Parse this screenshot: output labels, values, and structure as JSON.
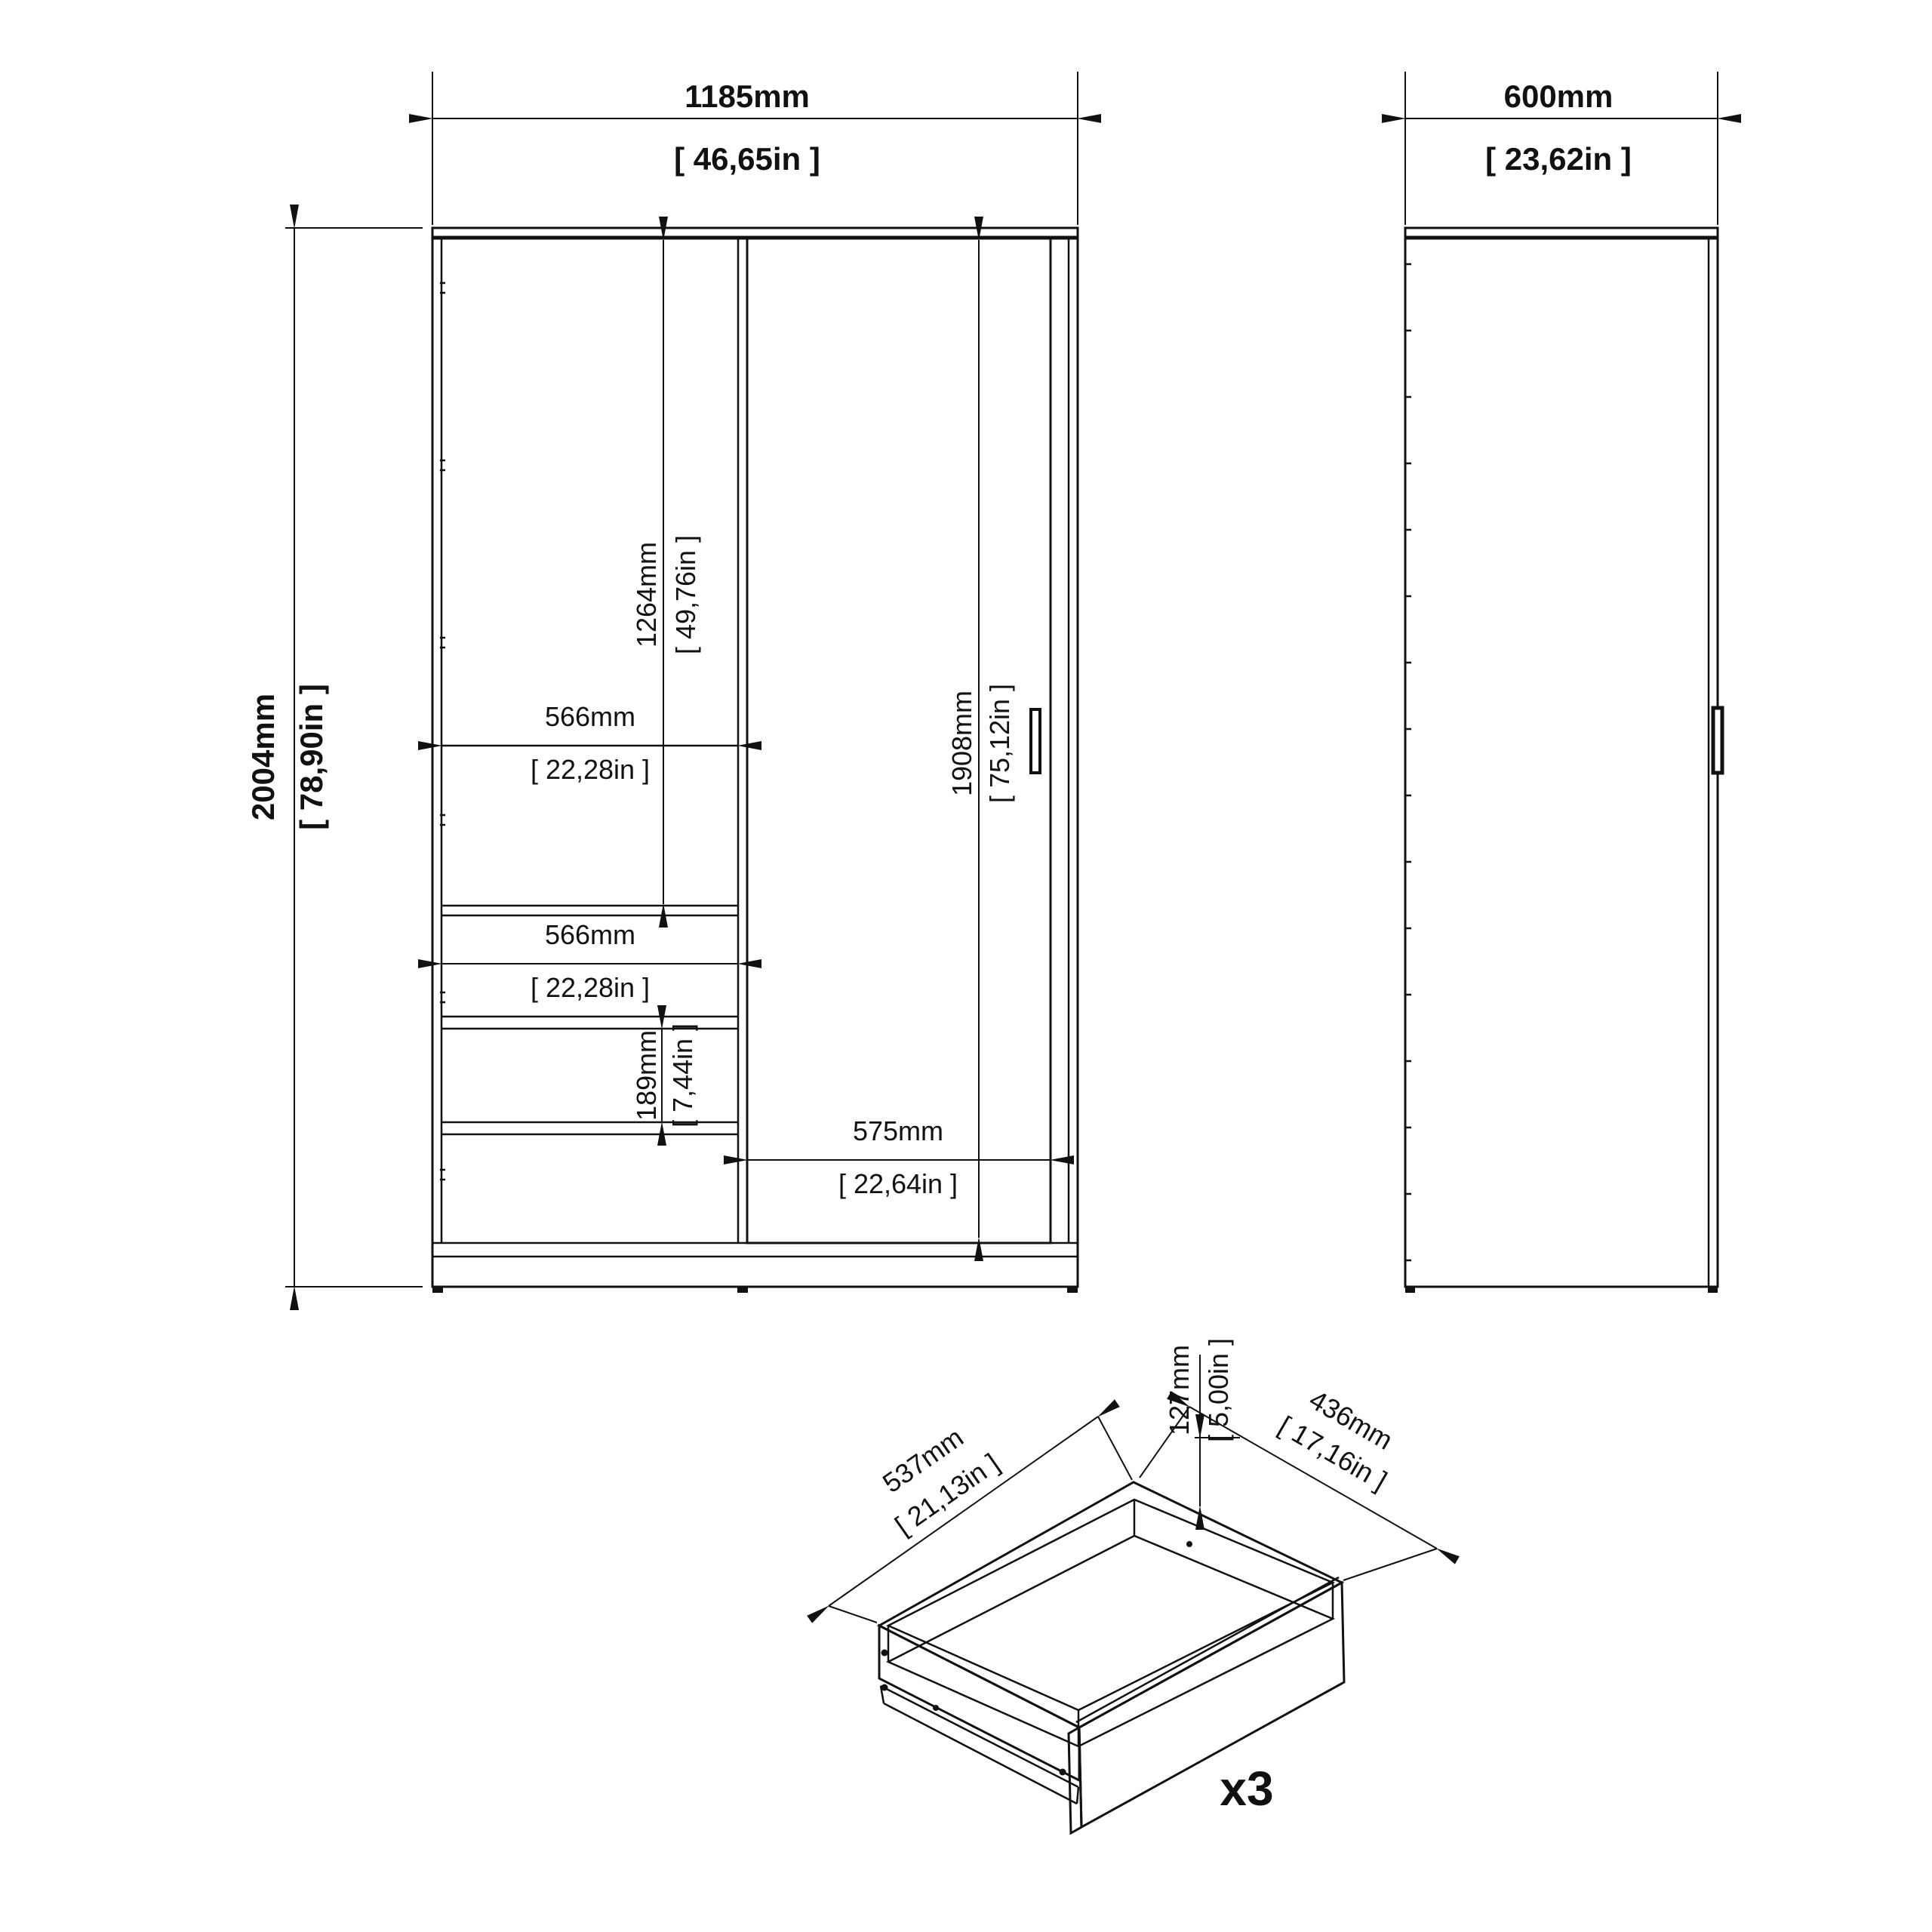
{
  "drawing": {
    "front_view": {
      "width_mm": "1185mm",
      "width_in": "[ 46,65in ]",
      "height_mm": "2004mm",
      "height_in": "[ 78,90in ]",
      "upper_section_height_mm": "1264mm",
      "upper_section_height_in": "[ 49,76in ]",
      "upper_shelf_width_mm": "566mm",
      "upper_shelf_width_in": "[ 22,28in ]",
      "door_height_mm": "1908mm",
      "door_height_in": "[ 75,12in ]",
      "drawer_section_width_mm": "566mm",
      "drawer_section_width_in": "[ 22,28in ]",
      "drawer_front_height_mm": "189mm",
      "drawer_front_height_in": "[ 7,44in ]",
      "door_width_mm": "575mm",
      "door_width_in": "[ 22,64in ]"
    },
    "side_view": {
      "depth_mm": "600mm",
      "depth_in": "[ 23,62in ]"
    },
    "drawer_detail": {
      "width_mm": "537mm",
      "width_in": "[ 21,13in ]",
      "depth_mm": "436mm",
      "depth_in": "[ 17,16in ]",
      "height_mm": "127mm",
      "height_in": "[ 5,00in ]",
      "quantity_label": "x3"
    },
    "colors": {
      "line": "#111111",
      "background": "#ffffff"
    }
  }
}
